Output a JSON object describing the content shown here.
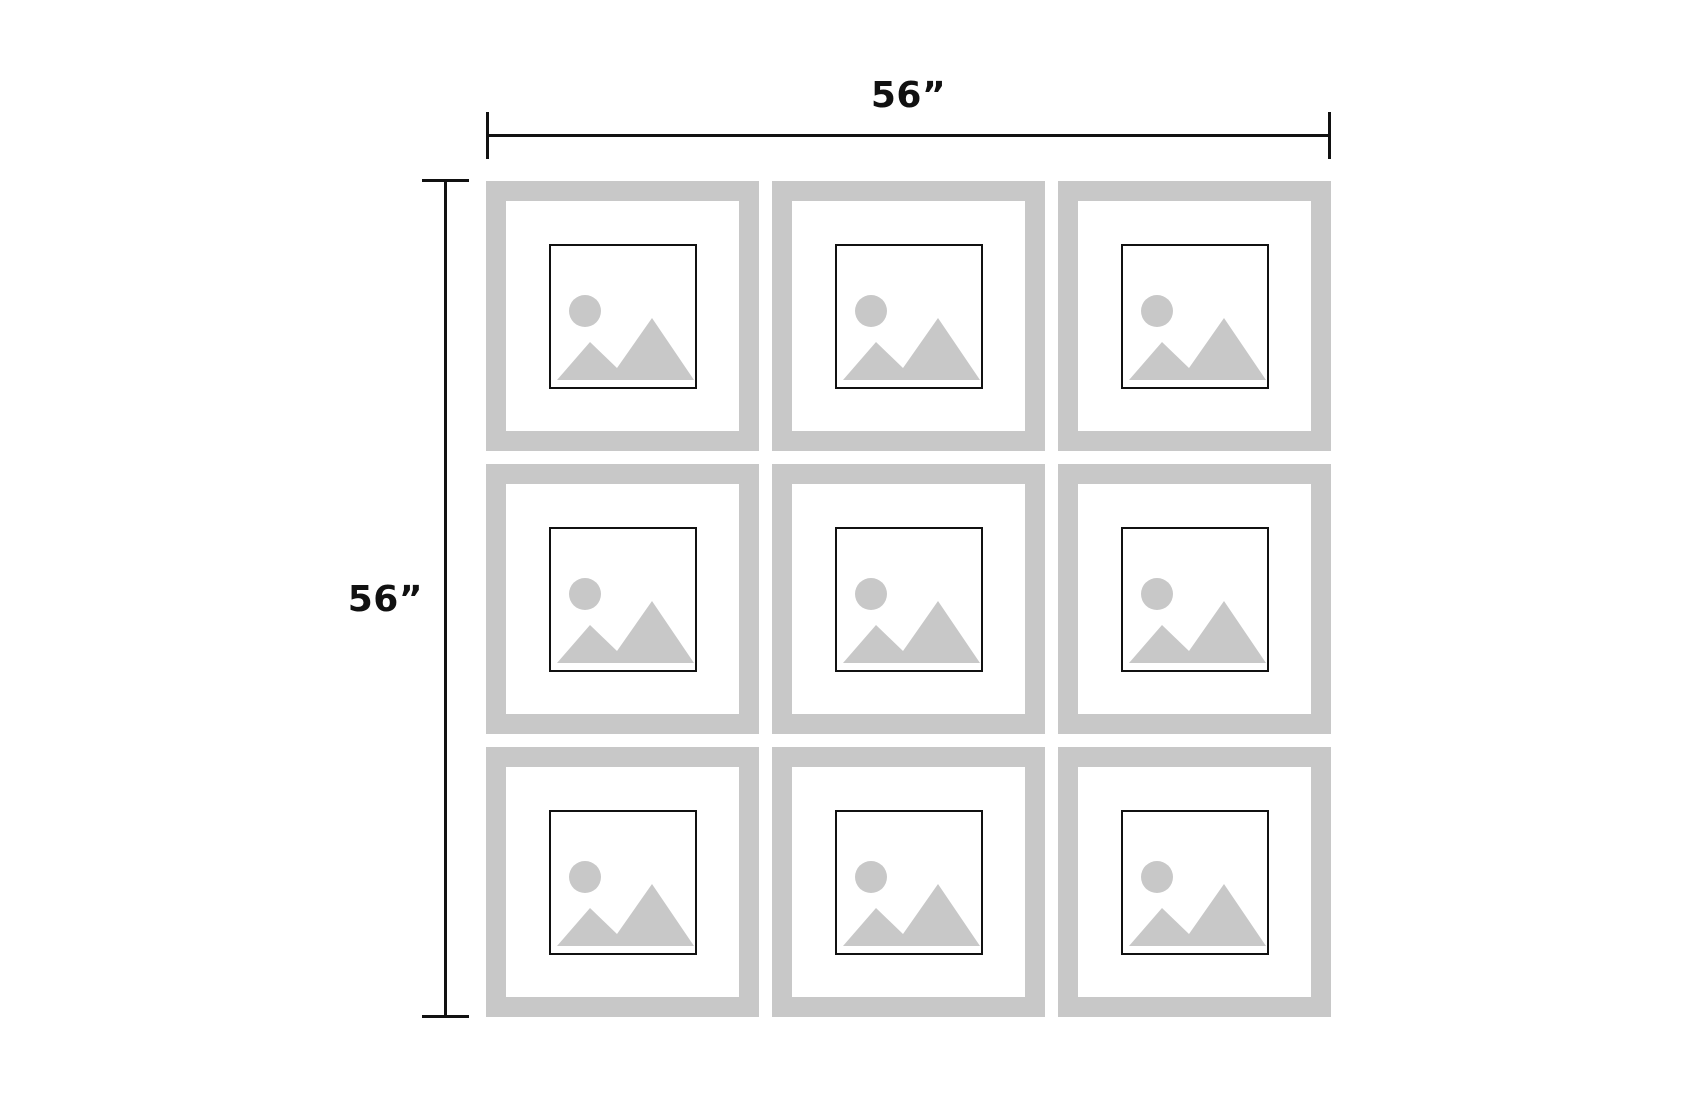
{
  "diagram": {
    "type": "gallery-wall-layout",
    "labels": {
      "width": "56”",
      "height": "56”"
    },
    "grid": {
      "rows": 3,
      "cols": 3,
      "frame_count": 9
    },
    "colors": {
      "background": "#ffffff",
      "frame_gray": "#c8c8c8",
      "icon_gray": "#c8c8c8",
      "line_black": "#111111"
    },
    "icon": {
      "name": "image-placeholder-icon",
      "parts": [
        "sun-circle",
        "mountains"
      ]
    }
  }
}
